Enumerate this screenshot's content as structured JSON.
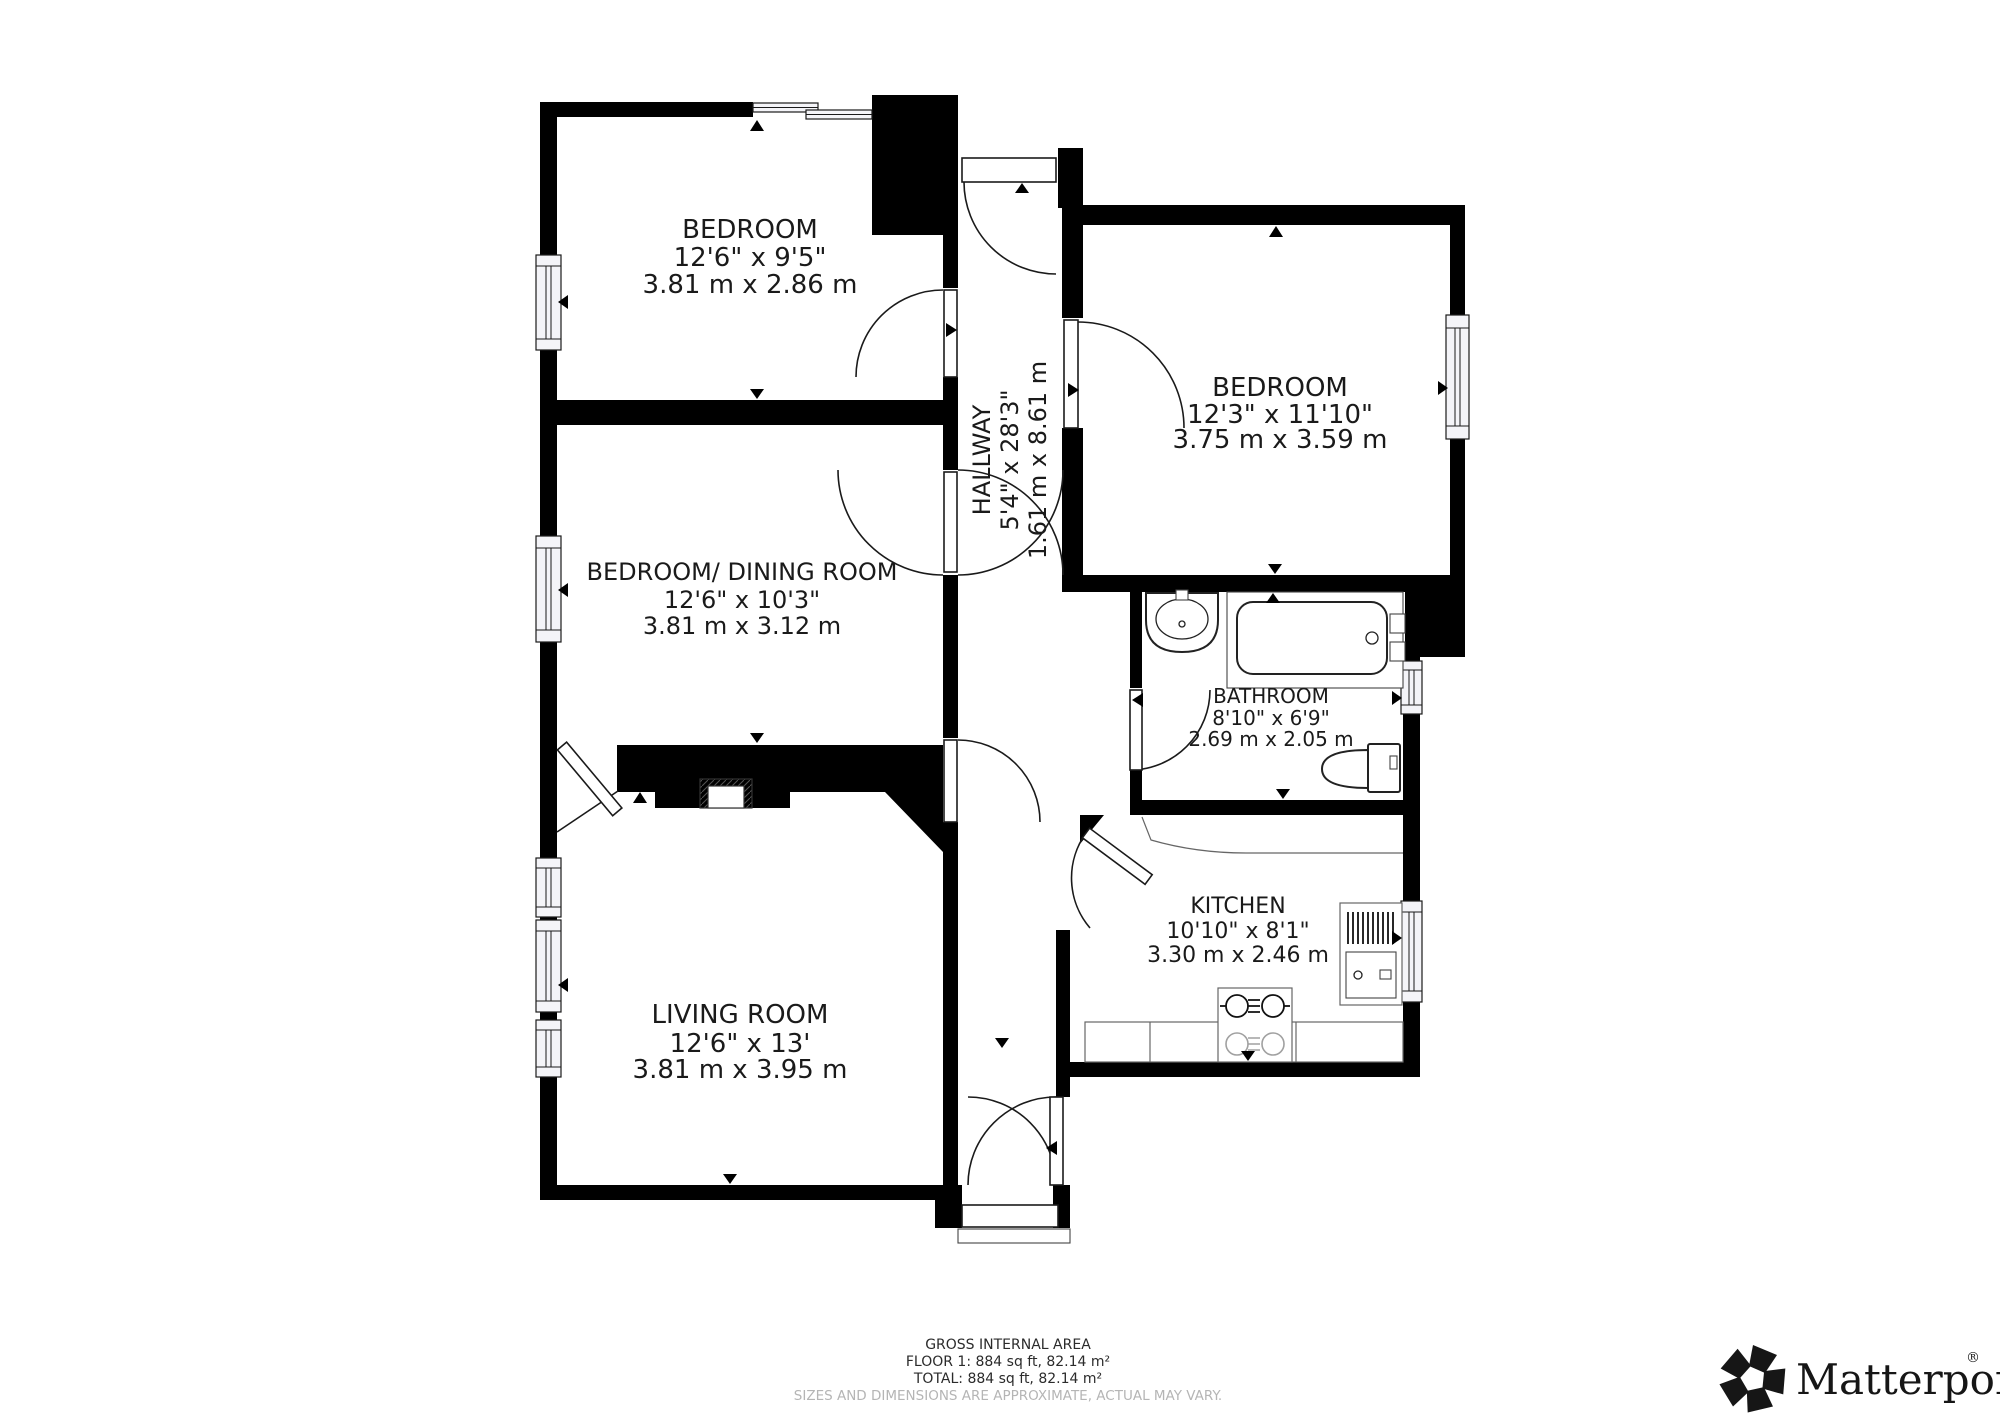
{
  "colors": {
    "wall": "#000000",
    "label_text": "#1a1a1a",
    "muted_text": "#b5b5b5",
    "background": "#ffffff"
  },
  "rooms": [
    {
      "name": "BEDROOM",
      "dim_imperial": "12'6\" x 9'5\"",
      "dim_metric": "3.81 m x 2.86 m"
    },
    {
      "name": "BEDROOM/ DINING ROOM",
      "dim_imperial": "12'6\" x 10'3\"",
      "dim_metric": "3.81 m x 3.12 m"
    },
    {
      "name": "LIVING ROOM",
      "dim_imperial": "12'6\" x 13'",
      "dim_metric": "3.81 m x 3.95 m"
    },
    {
      "name": "BEDROOM",
      "dim_imperial": "12'3\" x 11'10\"",
      "dim_metric": "3.75 m x 3.59 m"
    },
    {
      "name": "BATHROOM",
      "dim_imperial": "8'10\" x 6'9\"",
      "dim_metric": "2.69 m x 2.05 m"
    },
    {
      "name": "KITCHEN",
      "dim_imperial": "10'10\" x 8'1\"",
      "dim_metric": "3.30 m x 2.46 m"
    },
    {
      "name": "HALLWAY",
      "dim_imperial": "5'4\" x 28'3\"",
      "dim_metric": "1.61 m x 8.61 m"
    }
  ],
  "footer": {
    "title": "GROSS INTERNAL AREA",
    "floor_line": "FLOOR 1: 884 sq ft, 82.14 m²",
    "total_line": "TOTAL: 884 sq ft, 82.14 m²",
    "disclaimer": "SIZES AND DIMENSIONS ARE APPROXIMATE, ACTUAL MAY VARY."
  },
  "brand": {
    "wordmark": "Matterport",
    "registered_mark": "®"
  }
}
